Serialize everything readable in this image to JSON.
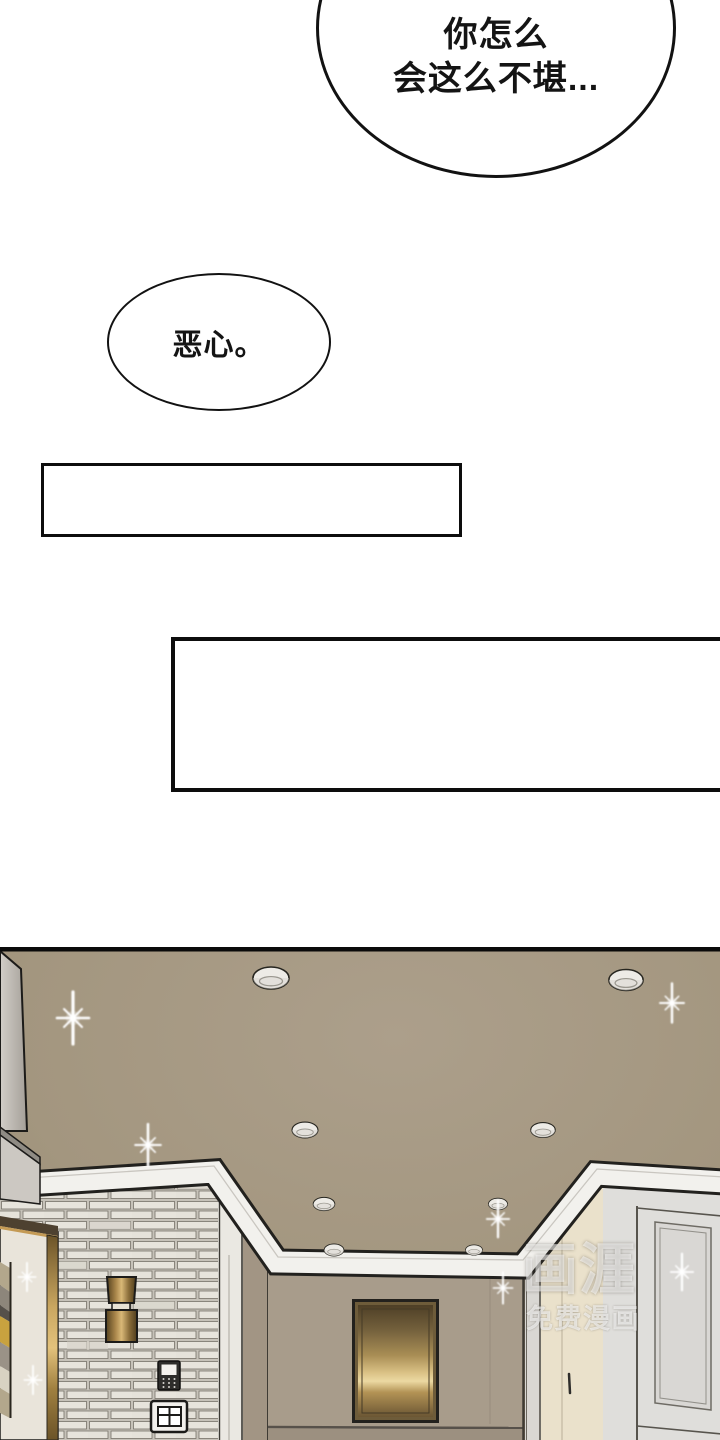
{
  "panel": {
    "bubble_top": {
      "lines": [
        "你怎么",
        "会这么不堪..."
      ]
    },
    "bubble_small": {
      "text": "恶心。"
    },
    "caption_box_1": {
      "text": ""
    },
    "caption_box_2": {
      "text": ""
    }
  },
  "watermark": {
    "logo": "画涯",
    "tagline": "免费漫画"
  },
  "scene": {
    "colors": {
      "panel_border": "#0a0a0a",
      "ceiling": "#a3967f",
      "back_wall": "#a89c8b",
      "side_jamb": "#a29584",
      "door_jamb_white": "#eae8e2",
      "pillar": "#d9d7d3",
      "brick": "#e9e6df",
      "brick_shade": "#d8d4cb",
      "mortar": "#c6c2b9",
      "molding": "#f2f1ed",
      "cabinet_front": "#ccc8c2",
      "cabinet_side": "#8f8b84",
      "frame_mat": "#e9e4da",
      "frame_bar": "#4e4130",
      "gold_bright": "#ecd9a2",
      "gold_dark": "#6b5634",
      "cream_door": "#eae1cb",
      "right_wall": "#dfdedb",
      "right_panel": "#d9d7d4",
      "floor_shadow": "#9c9080",
      "outline": "#1c1b19",
      "sparkle": "#ffffff"
    }
  }
}
